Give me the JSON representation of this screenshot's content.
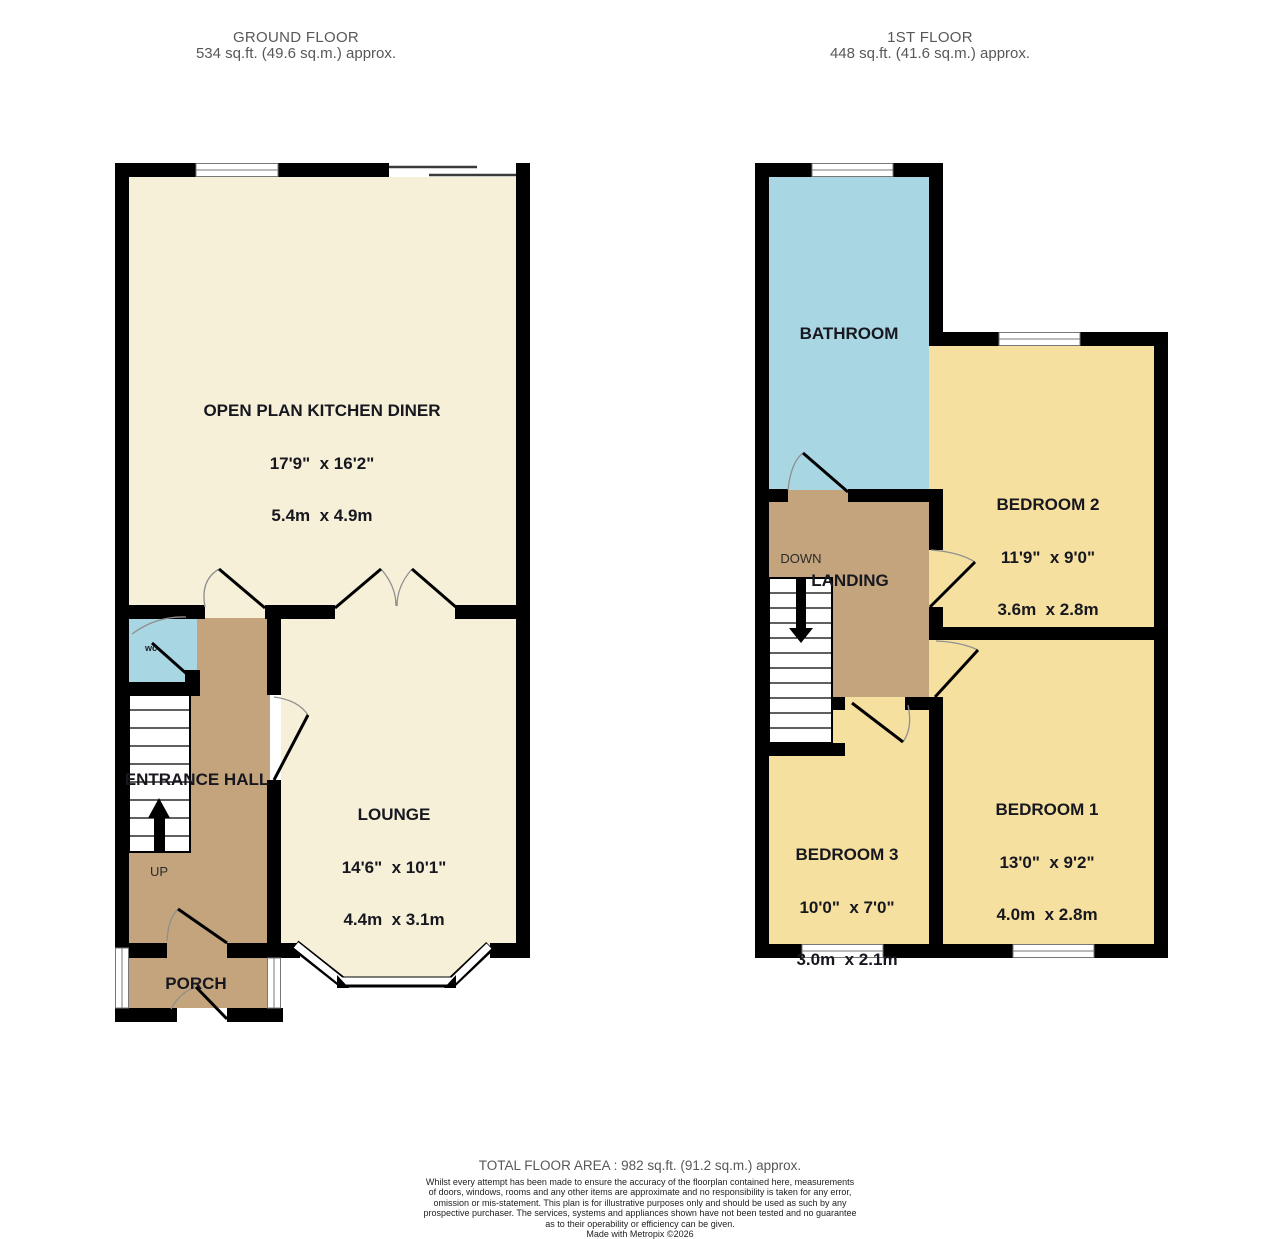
{
  "floors": {
    "ground": {
      "title": "GROUND FLOOR",
      "area": "534 sq.ft. (49.6 sq.m.) approx.",
      "rooms": {
        "kitchen": {
          "name": "OPEN PLAN KITCHEN DINER",
          "imperial": "17'9\"  x 16'2\"",
          "metric": "5.4m  x 4.9m"
        },
        "lounge": {
          "name": "LOUNGE",
          "imperial": "14'6\"  x 10'1\"",
          "metric": "4.4m  x 3.1m"
        },
        "hall": {
          "name": "ENTRANCE HALL"
        },
        "porch": {
          "name": "PORCH"
        },
        "wc": {
          "name": "wc"
        },
        "stairs": {
          "label": "UP"
        }
      }
    },
    "first": {
      "title": "1ST FLOOR",
      "area": "448 sq.ft. (41.6 sq.m.) approx.",
      "rooms": {
        "bathroom": {
          "name": "BATHROOM"
        },
        "bedroom2": {
          "name": "BEDROOM 2",
          "imperial": "11'9\"  x 9'0\"",
          "metric": "3.6m  x 2.8m"
        },
        "landing": {
          "name": "LANDING"
        },
        "bedroom1": {
          "name": "BEDROOM 1",
          "imperial": "13'0\"  x 9'2\"",
          "metric": "4.0m  x 2.8m"
        },
        "bedroom3": {
          "name": "BEDROOM 3",
          "imperial": "10'0\"  x 7'0\"",
          "metric": "3.0m  x 2.1m"
        },
        "stairs": {
          "label": "DOWN"
        }
      }
    }
  },
  "footer": {
    "total": "TOTAL FLOOR AREA : 982 sq.ft. (91.2 sq.m.) approx.",
    "disclaimer_lines": [
      "Whilst every attempt has been made to ensure the accuracy of the floorplan contained here, measurements",
      "of doors, windows, rooms and any other items are approximate and no responsibility is taken for any error,",
      "omission or mis-statement. This plan is for illustrative purposes only and should be used as such by any",
      "prospective purchaser. The services, systems and appliances shown have not been tested and no guarantee",
      "as to their operability or efficiency can be given.",
      "Made with Metropix ©2026"
    ]
  },
  "colors": {
    "wall": "#000000",
    "room_cream": "#f6f0d9",
    "room_yellow": "#f5e09f",
    "room_blue": "#a9d6e3",
    "room_tan": "#c3a47d",
    "header_text": "#585858",
    "label_text": "#17171f"
  }
}
